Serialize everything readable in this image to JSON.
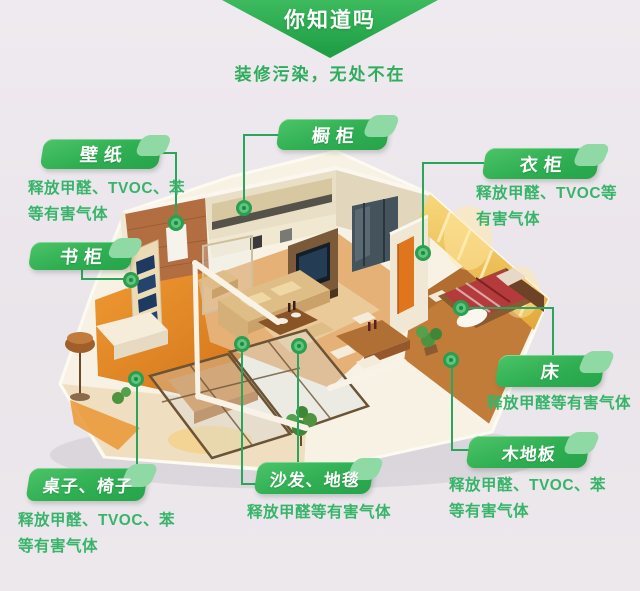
{
  "banner": {
    "title": "你知道吗"
  },
  "subtitle": "装修污染，无处不在",
  "colors": {
    "accent_green": "#2fad5c",
    "badge_green_light": "#4cc468",
    "badge_green_dark": "#27a44c",
    "connector_green": "#2aa55b",
    "background": "#ebe7eb"
  },
  "labels": {
    "wallpaper": {
      "name": "壁纸",
      "desc_lines": [
        "释放甲醛、TVOC、苯",
        "等有害气体"
      ]
    },
    "cupboard": {
      "name": "橱柜"
    },
    "wardrobe": {
      "name": "衣柜",
      "desc_lines": [
        "释放甲醛、TVOC等",
        "有害气体"
      ]
    },
    "bookcase": {
      "name": "书柜"
    },
    "bed": {
      "name": "床",
      "desc_lines": [
        "释放甲醛等有害气体"
      ]
    },
    "wood_floor": {
      "name": "木地板",
      "desc_lines": [
        "释放甲醛、TVOC、苯",
        "等有害气体"
      ]
    },
    "table_chairs": {
      "name": "桌子、椅子",
      "desc_lines": [
        "释放甲醛、TVOC、苯",
        "等有害气体"
      ]
    },
    "sofa_carpet": {
      "name": "沙发、地毯",
      "desc_lines": [
        "释放甲醛等有害气体"
      ]
    }
  }
}
